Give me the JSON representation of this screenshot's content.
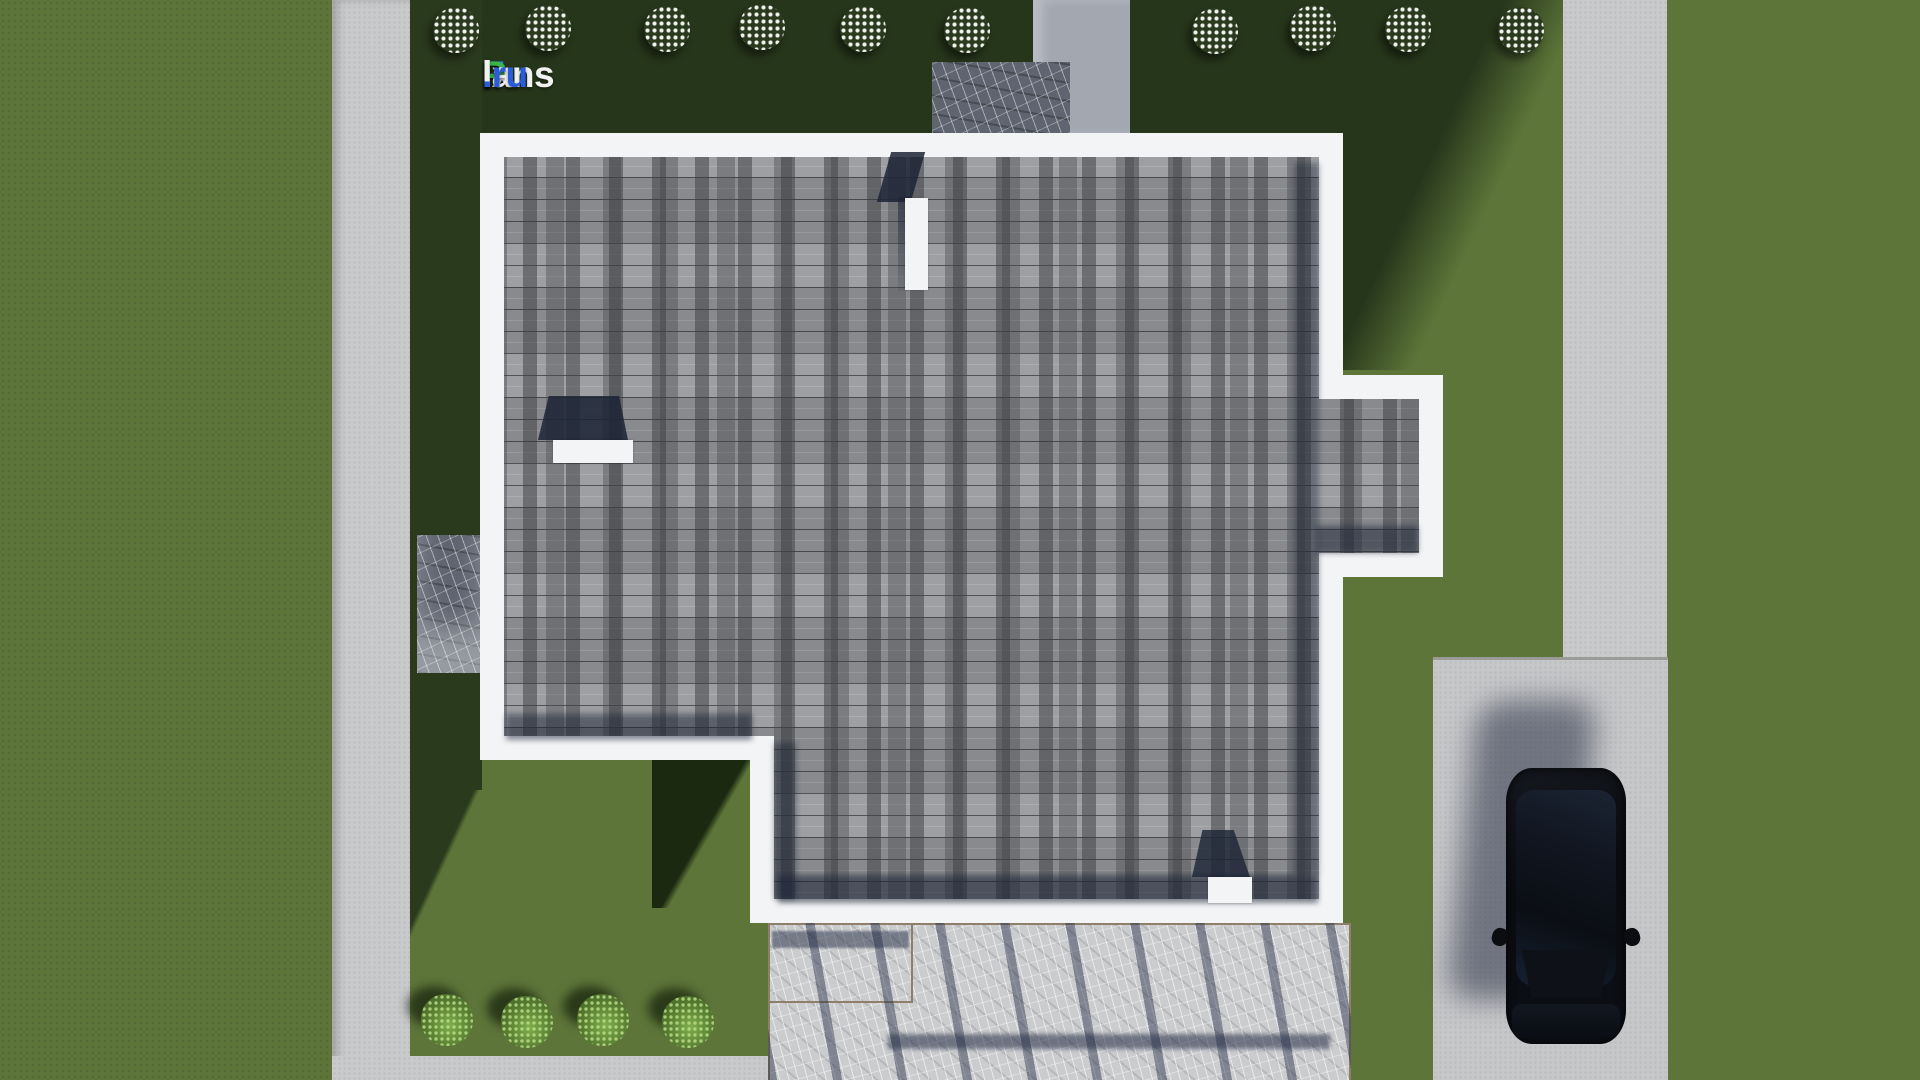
{
  "brand": {
    "name": "FixPlans.ru",
    "segments": [
      {
        "text": "F",
        "color": "#2e7fe8"
      },
      {
        "text": "ix",
        "color": "#f2f2f2"
      },
      {
        "text": "P",
        "color": "#39b54a"
      },
      {
        "text": "lans",
        "color": "#f2f2f2"
      },
      {
        "text": ".ru",
        "color": "#2a5cd8"
      }
    ]
  },
  "scene": {
    "description": "Aerial top-down 3D render of a flat-roof house on a landscaped lot",
    "house": {
      "roof_covering": "gray shingles",
      "parapet_color": "#f3f4f6",
      "shingle_color": "#96989b",
      "rooftop_features": [
        "chimney-top",
        "vent-left",
        "parapet-stub-bottom"
      ]
    },
    "landscape": {
      "grass_color": "#5d7539",
      "path_color": "#c9cacb",
      "driveway_color": "#c6c7c9",
      "flowering_bushes_top": 10,
      "green_bushes_bottom": 4,
      "stone_pads": 2
    },
    "terrace": {
      "material": "light stone tiles",
      "border_color": "#8d7f6c",
      "pergola_shadow": true
    },
    "vehicle": {
      "type": "suv",
      "color": "black",
      "location": "driveway"
    }
  }
}
